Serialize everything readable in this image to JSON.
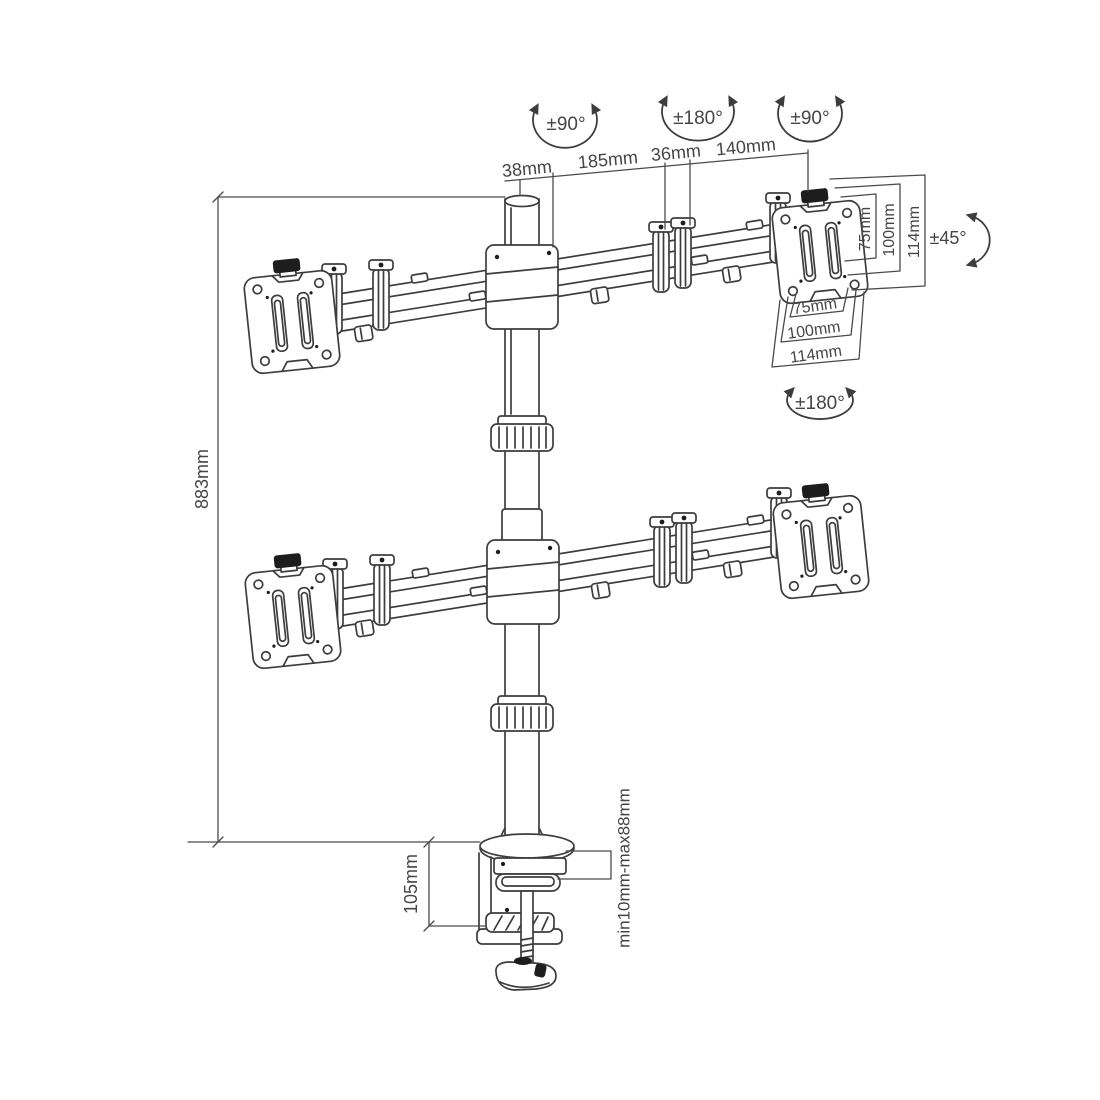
{
  "drawing": {
    "kind": "technical-dimension-diagram",
    "subject": "quad-monitor-desk-mount-arm",
    "line_color": "#3d3d3d",
    "text_color": "#454545",
    "background": "#ffffff"
  },
  "rotation_labels": {
    "top_left": "±90°",
    "top_center": "±180°",
    "top_right": "±90°",
    "tilt_right": "±45°",
    "vesa_swivel": "±180°"
  },
  "top_dimensions": [
    "38mm",
    "185mm",
    "36mm",
    "140mm"
  ],
  "height_dimension": "883mm",
  "clamp_height_dimension": "105mm",
  "clamp_range_dimension": "min10mm-max88mm",
  "vesa_side_dimensions": [
    "75mm",
    "100mm",
    "114mm"
  ],
  "vesa_bottom_dimensions": [
    "75mm",
    "100mm",
    "114mm"
  ]
}
